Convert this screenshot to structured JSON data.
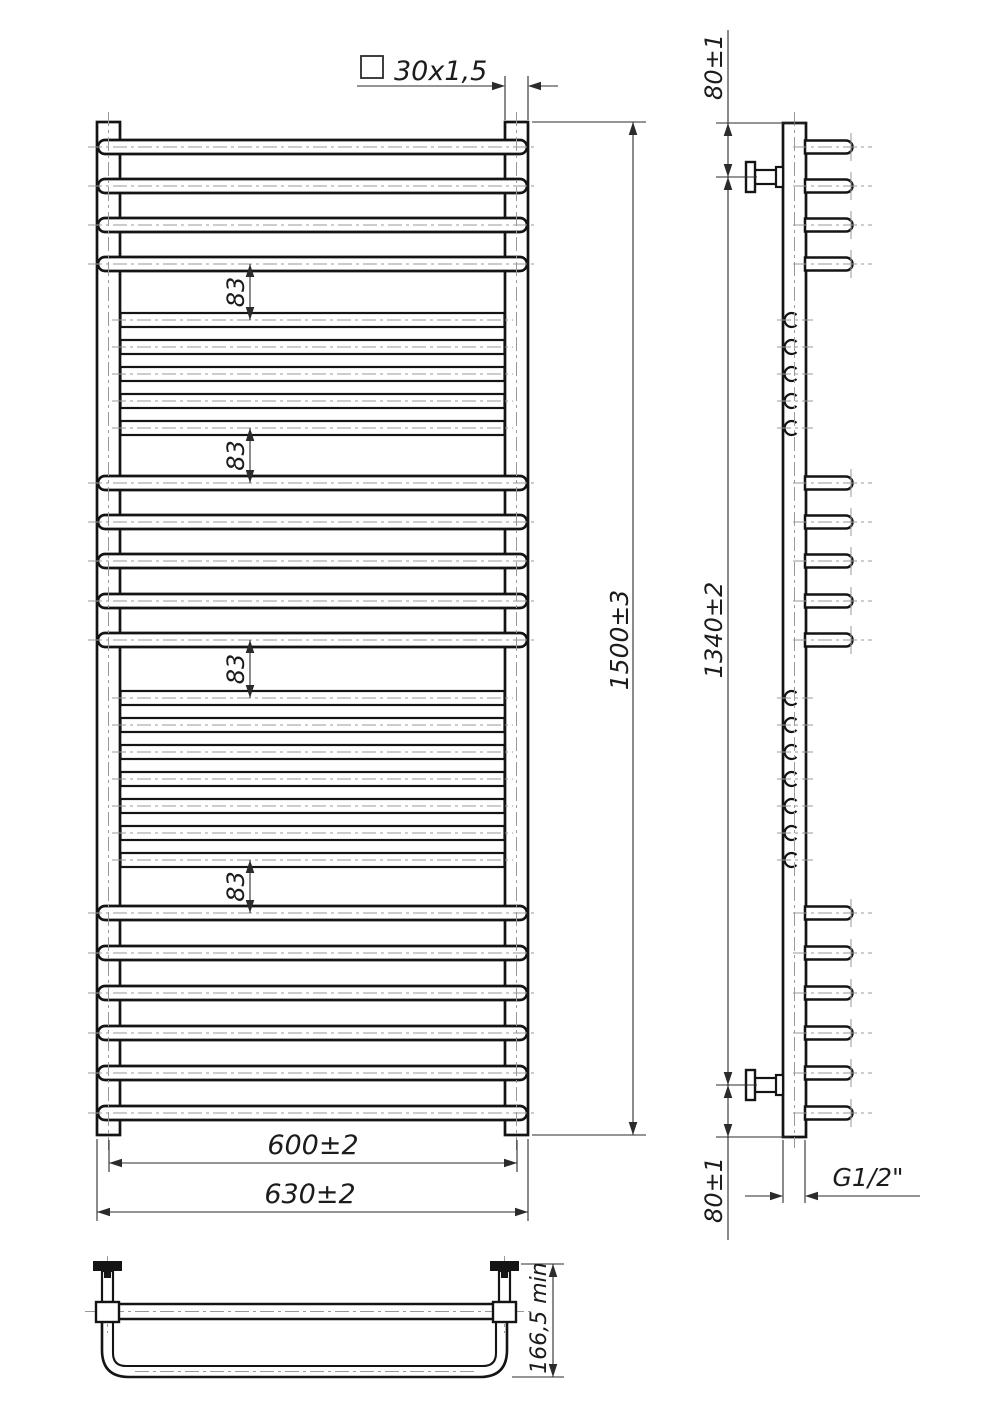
{
  "drawing": {
    "background": "#ffffff",
    "line_color": "#141414",
    "dim_color": "#2b2b2b",
    "centerline_color": "#999999",
    "front_view": {
      "profile_note": "30x1,5",
      "profile_symbol": "square",
      "height_dim": "1500±3",
      "gap_dims": [
        "83",
        "83",
        "83",
        "83"
      ],
      "axis_width_dim": "600±2",
      "overall_width_dim": "630±2",
      "wide_rungs_y": [
        147,
        186,
        225,
        264,
        483,
        522,
        561,
        601,
        640,
        913,
        953,
        993,
        1033,
        1073,
        1113
      ],
      "narrow_rungs_y": [
        320,
        347,
        374,
        401,
        428,
        698,
        725,
        752,
        779,
        806,
        833,
        860
      ],
      "gap_dim_spans": [
        [
          264,
          320
        ],
        [
          428,
          483
        ],
        [
          640,
          698
        ],
        [
          860,
          913
        ]
      ]
    },
    "side_view": {
      "top_offset_dim": "80±1",
      "axis_span_dim": "1340±2",
      "bottom_offset_dim": "80±1",
      "thread_dim": "G1/2\""
    },
    "bottom_view": {
      "depth_dim": "166,5 min"
    }
  }
}
